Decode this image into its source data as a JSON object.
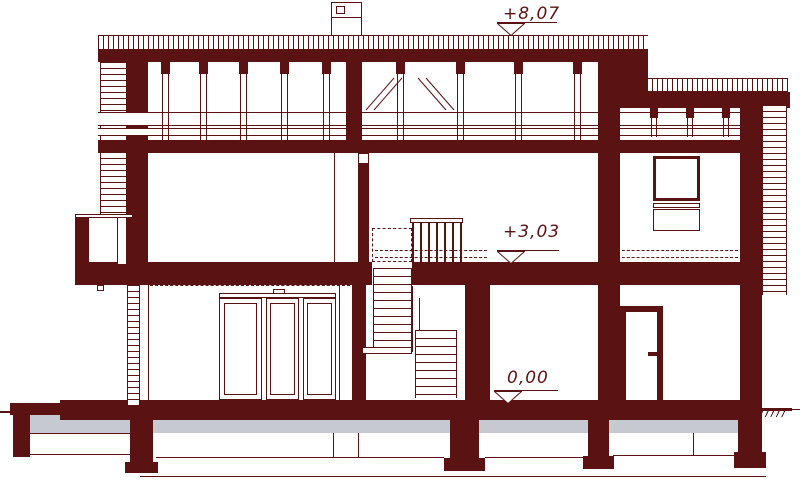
{
  "drawing": {
    "title": "House cross-section",
    "kind": "architectural-cross-section",
    "colors": {
      "structure": "#5a1312",
      "ground_fill": "#c6cad0",
      "background": "#ffffff"
    },
    "levels": [
      {
        "id": "roof",
        "label": "+8,07"
      },
      {
        "id": "first-floor",
        "label": "+3,03"
      },
      {
        "id": "ground-floor",
        "label": "0,00"
      }
    ]
  }
}
